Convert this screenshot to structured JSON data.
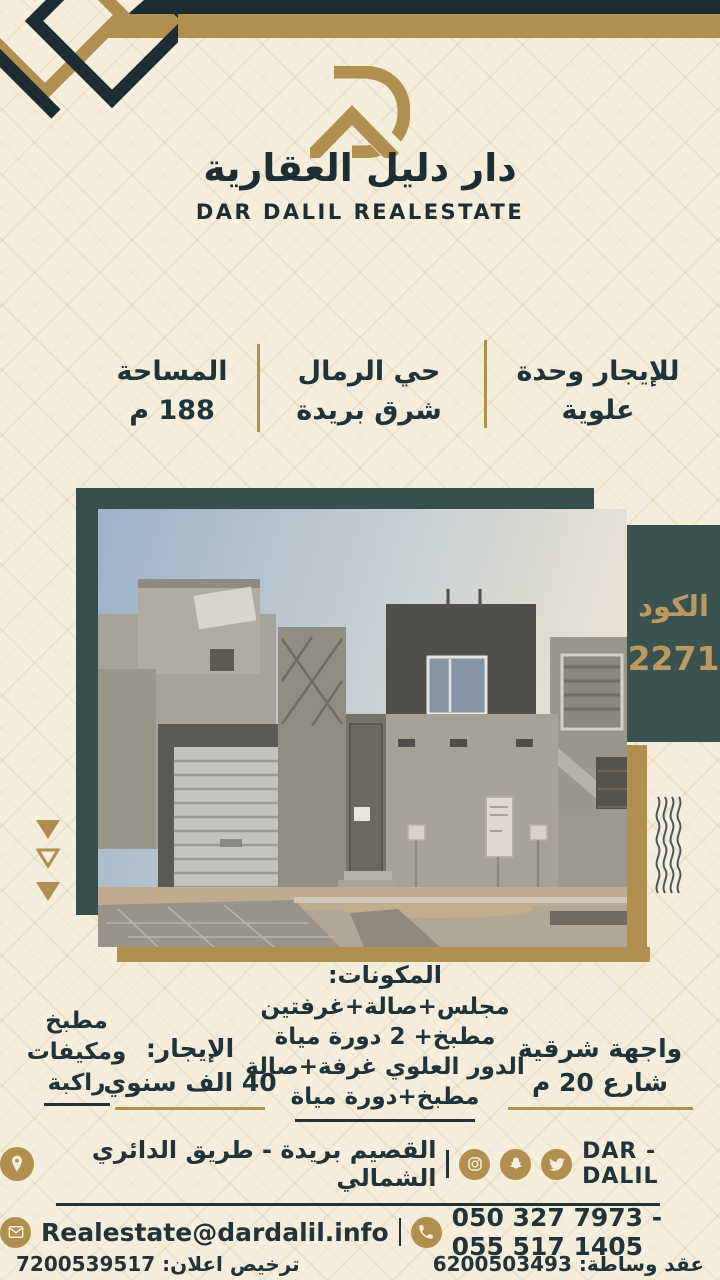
{
  "header": {
    "brand_ar": "دار دليل العقارية",
    "brand_en": "DAR DALIL REALESTATE"
  },
  "info": {
    "offer": [
      "للإيجار وحدة",
      "علوية"
    ],
    "location": [
      "حي الرمال",
      "شرق بريدة"
    ],
    "area": [
      "المساحة",
      "188 م"
    ]
  },
  "code_box": {
    "label": "الكود",
    "value": "2271"
  },
  "details": {
    "components_title": "المكونات:",
    "components": [
      "مجلس+صالة+غرفتين",
      "مطبخ+ 2 دورة مياة",
      "الدور العلوي غرفة+صالة",
      "مطبخ+دورة مياة"
    ],
    "facade": [
      "واجهة شرقية",
      "شارع 20 م"
    ],
    "rent": [
      "الإيجار:",
      "40 الف سنوي"
    ],
    "extras": [
      "مطبخ",
      "ومكيفات",
      "راكبة"
    ]
  },
  "footer": {
    "brand": "DAR - DALIL",
    "address": "القصيم بريدة - طريق الدائري الشمالي",
    "email": "Realestate@dardalil.info",
    "phones": "050 327 7973 - 055 517 1405",
    "brokerage": "عقد وساطة: 6200503493",
    "license": "ترخيص اعلان: 7200539517",
    "social_icons": [
      "instagram",
      "snapchat",
      "twitter"
    ],
    "contact_icons": [
      "location-pin",
      "email",
      "phone"
    ]
  },
  "colors": {
    "cream": "#f5eedd",
    "navy": "#1f3036",
    "teal": "#3a5351",
    "gold": "#b08f4f"
  }
}
